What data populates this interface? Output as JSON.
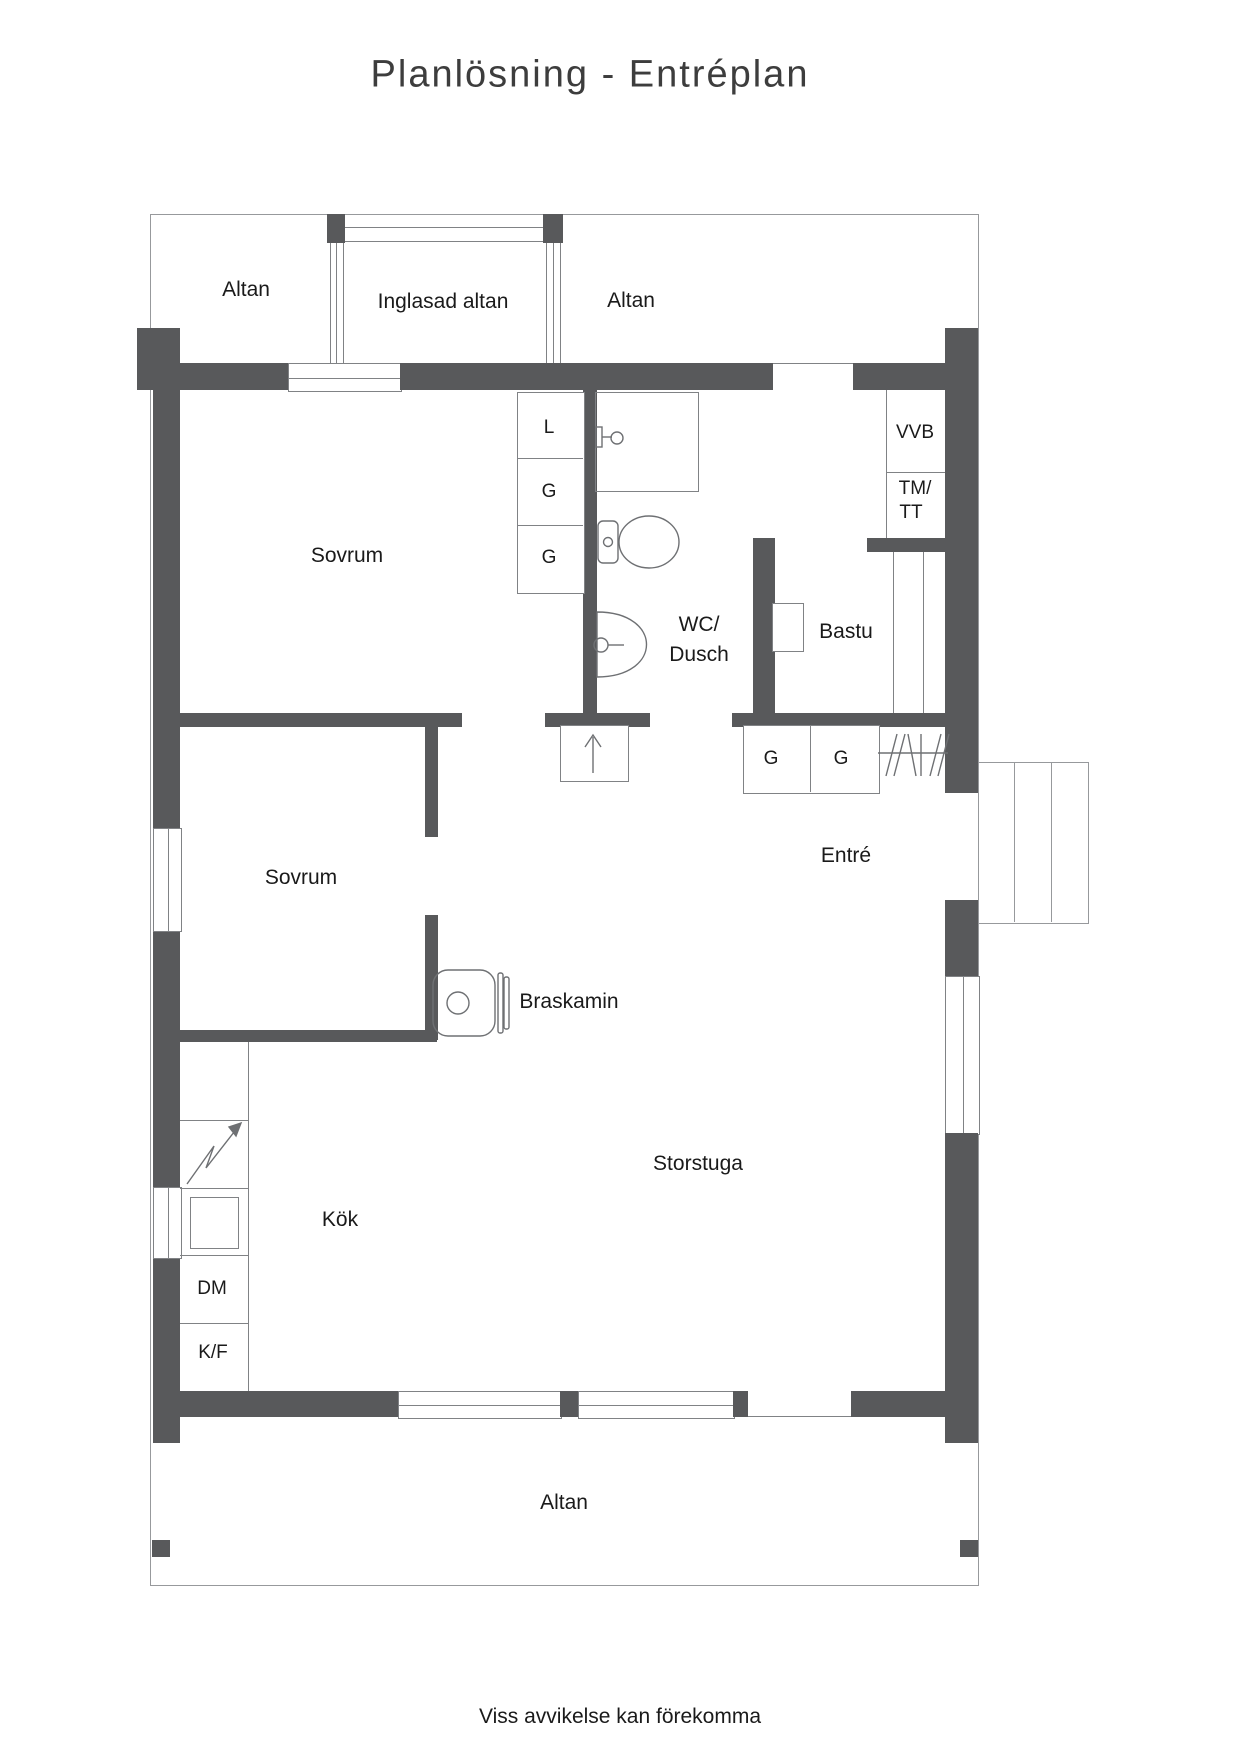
{
  "title": "Planlösning - Entréplan",
  "footer": {
    "disclaimer": "Viss avvikelse kan förekomma"
  },
  "colors": {
    "wall": "#58595b",
    "thin_line": "#808285",
    "text": "#1a1a1a",
    "title_text": "#3d3d3d"
  },
  "rooms": {
    "altan_top_left": {
      "label": "Altan"
    },
    "inglasad_altan": {
      "label": "Inglasad altan"
    },
    "altan_top_right": {
      "label": "Altan"
    },
    "sovrum_upper": {
      "label": "Sovrum"
    },
    "wc_dusch": {
      "label_line1": "WC/",
      "label_line2": "Dusch"
    },
    "bastu": {
      "label": "Bastu"
    },
    "entre": {
      "label": "Entré"
    },
    "sovrum_lower": {
      "label": "Sovrum"
    },
    "storstuga": {
      "label": "Storstuga"
    },
    "kok": {
      "label": "Kök"
    },
    "altan_bottom": {
      "label": "Altan"
    }
  },
  "fixtures": {
    "linen_closet": "L",
    "wardrobe_1": "G",
    "wardrobe_2": "G",
    "water_heater": "VVB",
    "washing_machine_line1": "TM/",
    "washing_machine_line2": "TT",
    "entre_wardrobe_1": "G",
    "entre_wardrobe_2": "G",
    "fireplace": "Braskamin",
    "dishwasher": "DM",
    "fridge_freezer": "K/F"
  }
}
